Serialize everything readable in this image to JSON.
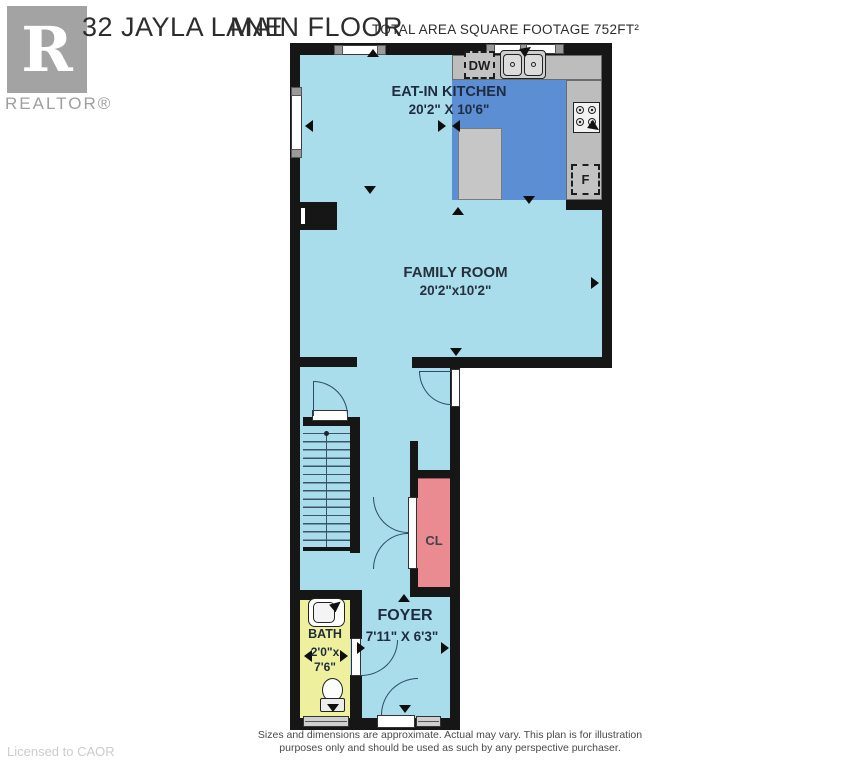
{
  "header": {
    "address": "32 JAYLA LANE",
    "floor": "MAIN FLOOR",
    "area": "TOTAL AREA SQUARE FOOTAGE 752FT²"
  },
  "branding": {
    "logo_letter": "R",
    "logo_text": "REALTOR®",
    "license": "Licensed to CAOR"
  },
  "rooms": {
    "kitchen": {
      "name": "EAT-IN KITCHEN",
      "dims": "20'2\" X 10'6\""
    },
    "family": {
      "name": "FAMILY ROOM",
      "dims": "20'2\"x10'2\""
    },
    "foyer": {
      "name": "FOYER",
      "dims": "7'11\" X 6'3\""
    },
    "bath": {
      "name": "BATH",
      "dims_line1": "2'0\"x",
      "dims_line2": "7'6\""
    },
    "closet": {
      "label": "CL"
    }
  },
  "appliances": {
    "dishwasher": "DW",
    "fridge": "F"
  },
  "footer": {
    "disclaimer_line1": "Sizes and dimensions are approximate. Actual may vary. This plan is for illustration",
    "disclaimer_line2": "purposes only and should be used as such by any perspective purchaser."
  },
  "colors": {
    "floor": "#a9ddec",
    "kitchen_highlight": "#5b8ed2",
    "counter": "#bdbdbd",
    "closet": "#ea8b92",
    "bath": "#eef09d",
    "wall": "#161616"
  }
}
